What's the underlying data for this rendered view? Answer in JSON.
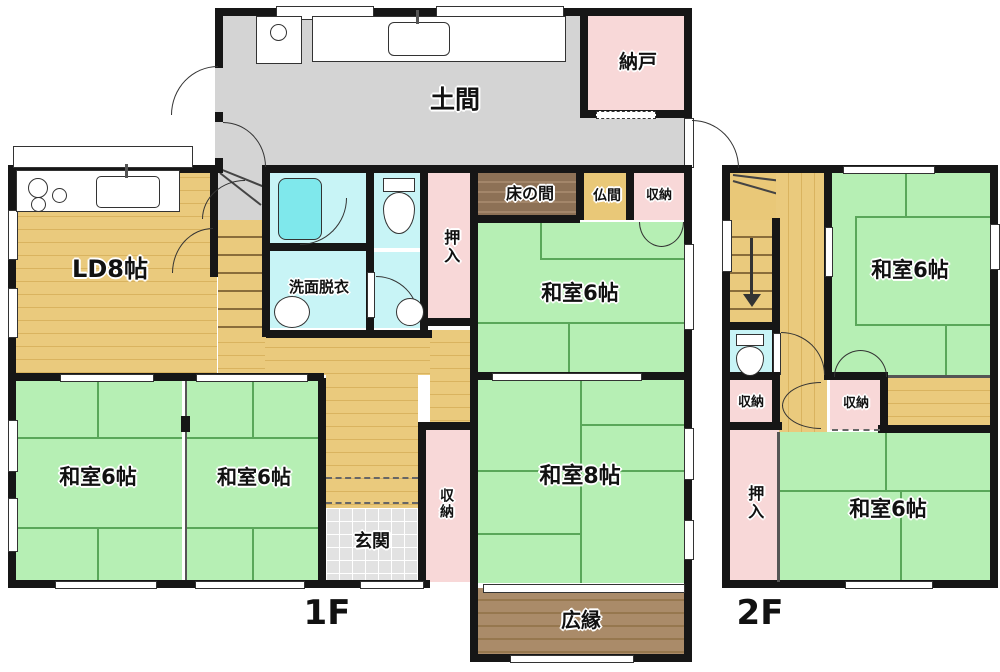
{
  "plan_title": "2-story Japanese house floor plan",
  "floors": {
    "f1": "1F",
    "f2": "2F"
  },
  "rooms": {
    "doma": "土間",
    "nando": "納戸",
    "ld": "LD8帖",
    "tokonoma": "床の間",
    "butsuma": "仏間",
    "storage": "収納",
    "oshiire": "押入",
    "washitsu6": "和室6帖",
    "washitsu8": "和室8帖",
    "senmen": "洗面脱衣",
    "genkan": "玄関",
    "hiroen": "広縁"
  },
  "colors": {
    "tatami_green": "#b6efb4",
    "wood_tan": "#e9c979",
    "doma_gray": "#d4d4d4",
    "closet_pink": "#f8d8d8",
    "bath_cyan": "#c8f4f6",
    "bathtub_cyan": "#7fe8ec",
    "tokonoma_brown": "#8d7156",
    "hiroen_brown": "#aa8b69",
    "butsuma_tan": "#e9c878",
    "genkan_gray": "#e2e2e2",
    "wall_black": "#161616"
  }
}
